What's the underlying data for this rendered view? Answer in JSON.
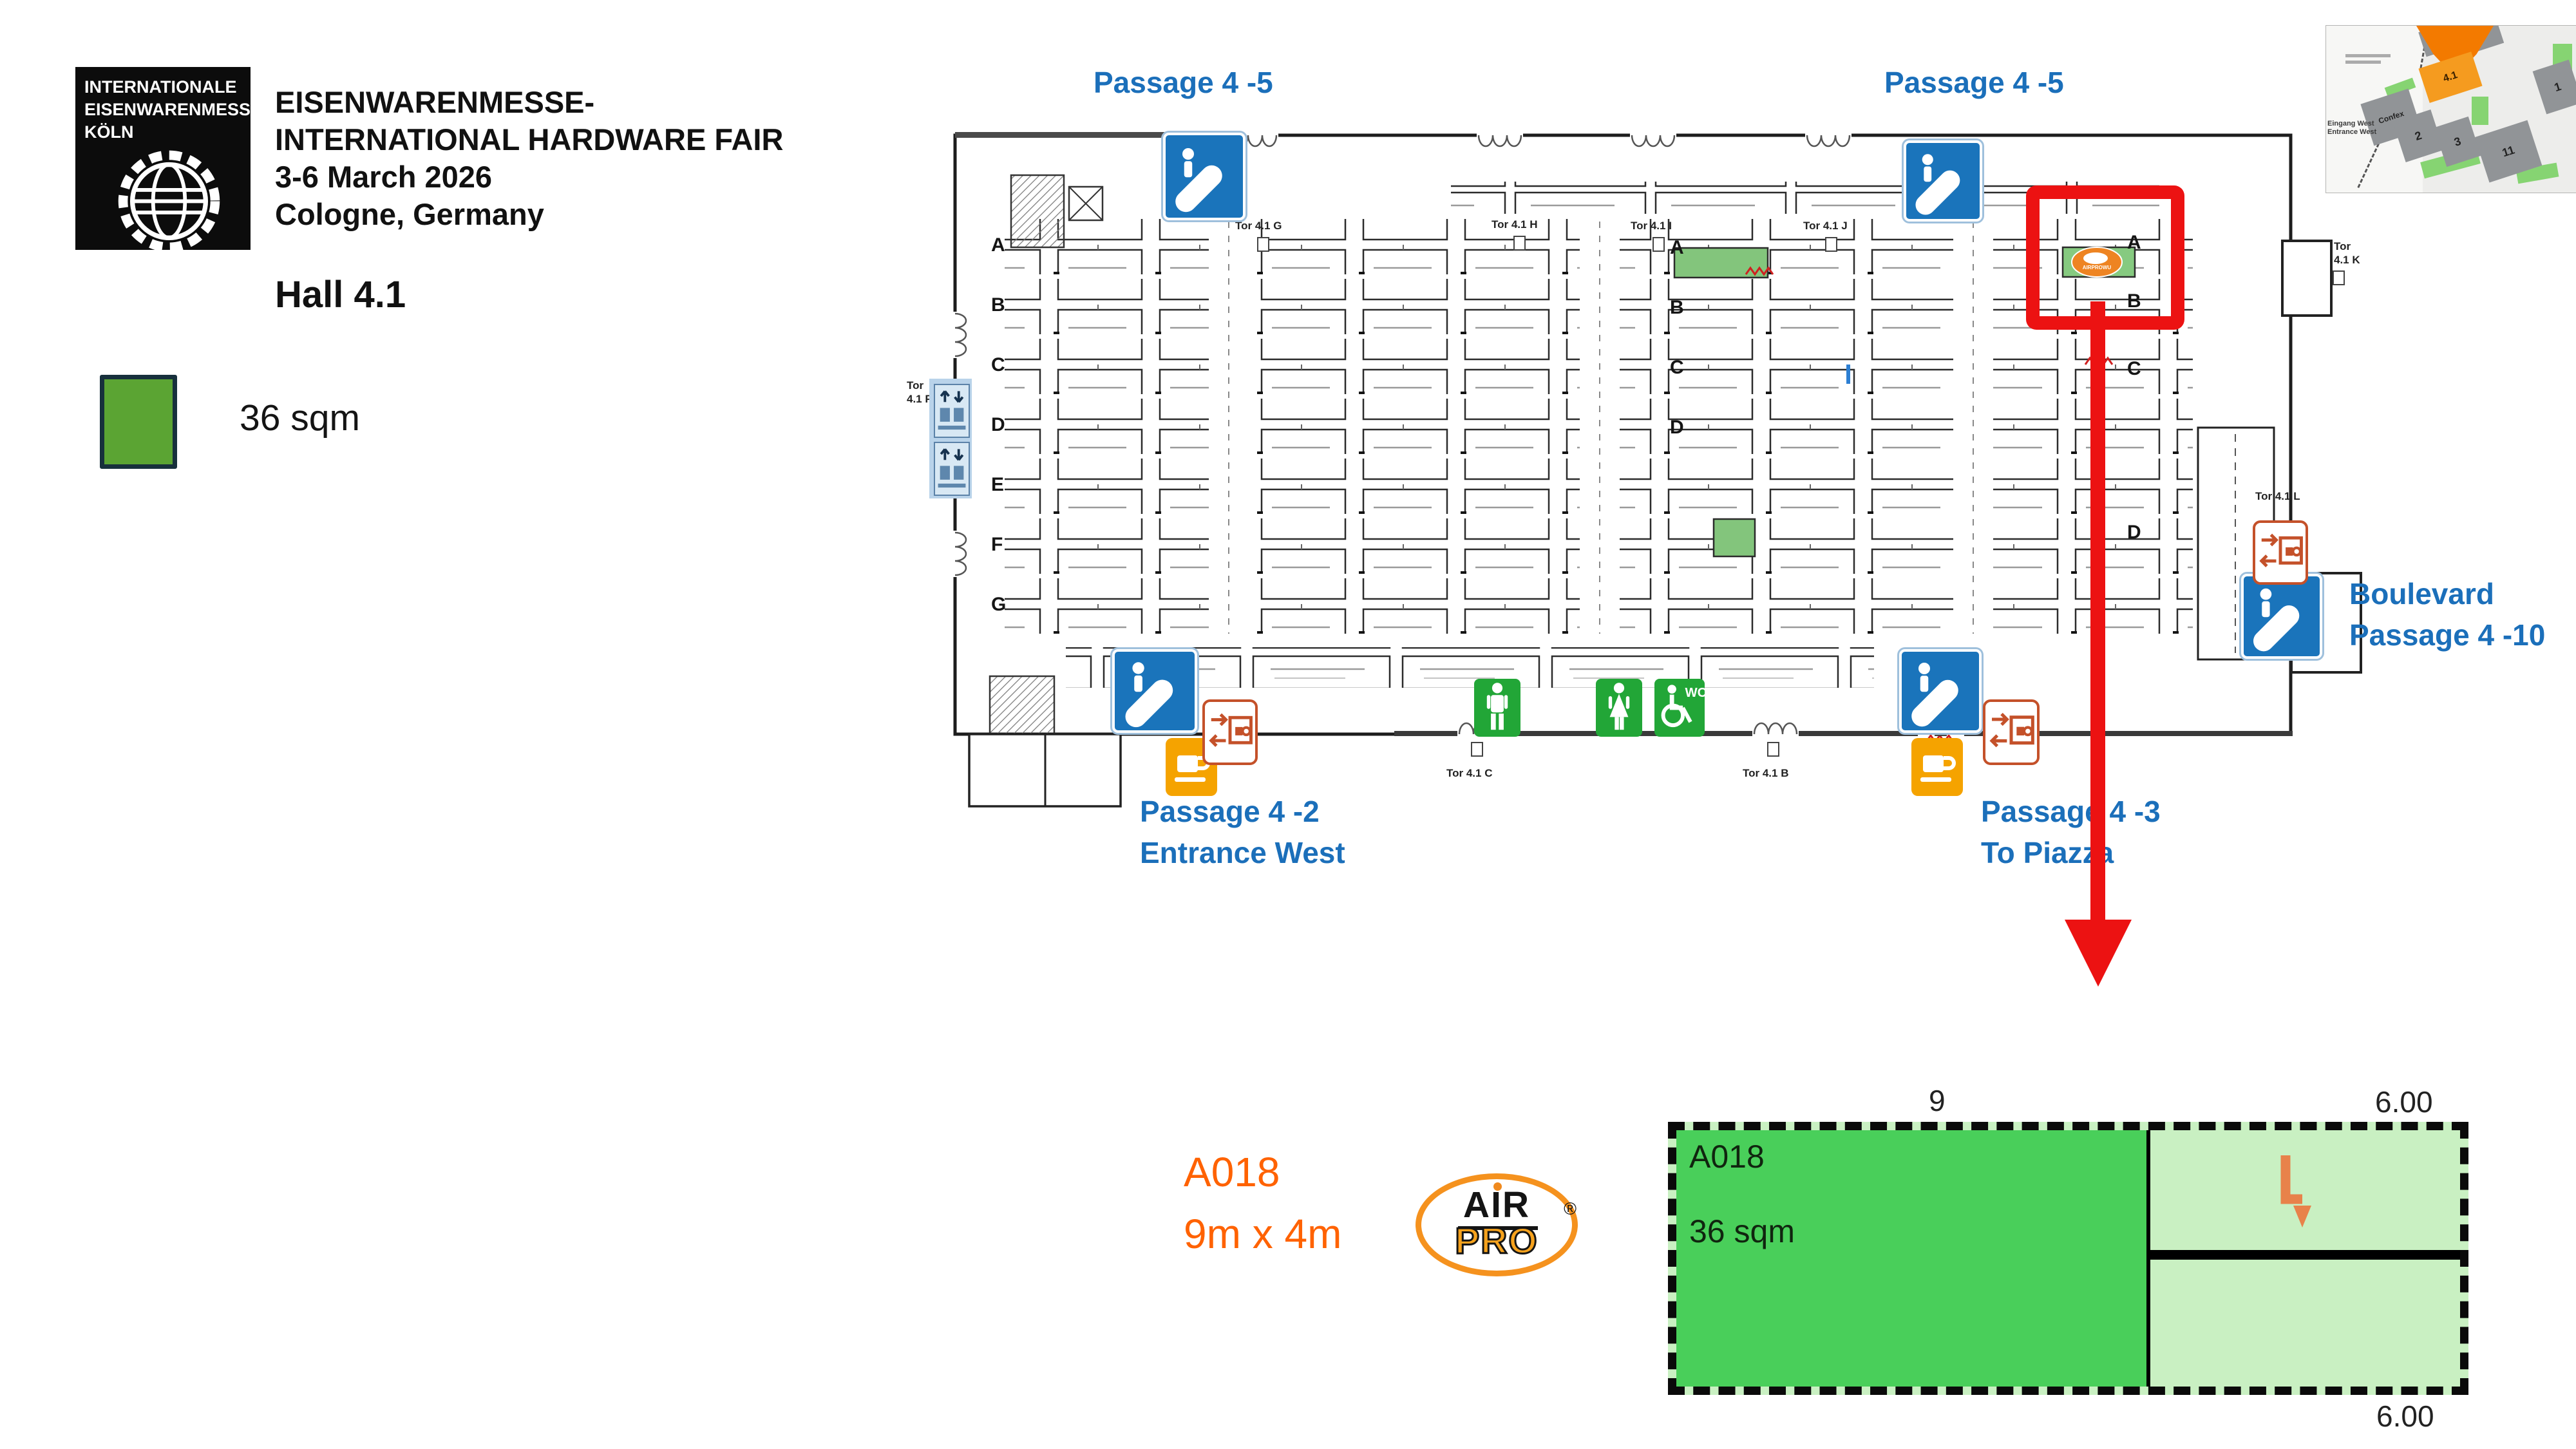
{
  "header": {
    "logo_lines": [
      "INTERNATIONALE",
      "EISENWARENMESSE",
      "KÖLN"
    ],
    "title_lines": [
      "EISENWARENMESSE-",
      "INTERNATIONAL HARDWARE FAIR",
      "3-6 March 2026",
      "Cologne, Germany"
    ],
    "hall": "Hall 4.1"
  },
  "legend": {
    "label": "36 sqm"
  },
  "plan": {
    "passages": {
      "top_left": "Passage 4 -5",
      "top_right": "Passage 4 -5",
      "bottom_left": [
        "Passage 4 -2",
        "Entrance West"
      ],
      "bottom_right": [
        "Passage 4 -3",
        "To Piazza"
      ],
      "boulevard": [
        "Boulevard",
        "Passage 4 -10"
      ]
    },
    "tors": {
      "g": "Tor 4.1 G",
      "h": "Tor 4.1 H",
      "i": "Tor 4.1 I",
      "j": "Tor 4.1 J",
      "k1": "Tor",
      "k2": "4.1 K",
      "l": "Tor 4.1 L",
      "a": "Tor 4.1 A",
      "b": "Tor 4.1 B",
      "c": "Tor 4.1 C",
      "f1": "Tor",
      "f2": "4.1 F"
    },
    "row_letters": [
      "A",
      "B",
      "C",
      "D",
      "E",
      "F",
      "G"
    ],
    "wc": "WC",
    "highlight_booth_logo_text": "AIRPROWU"
  },
  "minimap": {
    "current_hall": "4.1",
    "halls": [
      "2",
      "3",
      "11",
      "1"
    ],
    "confex": "Confex",
    "entrance": [
      "Eingang West",
      "Entrance West"
    ]
  },
  "detail": {
    "code": "A018",
    "area": "36 sqm",
    "top_width": "9",
    "right_width_top": "6.00",
    "right_width_bottom": "6.00"
  },
  "callout": {
    "code": "A018",
    "dims": "9m x 4m"
  },
  "brand": {
    "top": "AIR",
    "bottom": "PRO",
    "registered": "®"
  },
  "colors": {
    "passage_blue": "#1b6fba",
    "highlight_red": "#ec1212",
    "booth_green": "#49cf5a",
    "booth_light_green": "#c9f0c2",
    "legend_green": "#5ba433",
    "brand_orange": "#f5921e",
    "callout_orange": "#ff6200",
    "escalator_blue": "#1a74bb",
    "coffee_yellow": "#f5a300",
    "wc_green": "#22a637",
    "charge_orange": "#c4512a"
  }
}
